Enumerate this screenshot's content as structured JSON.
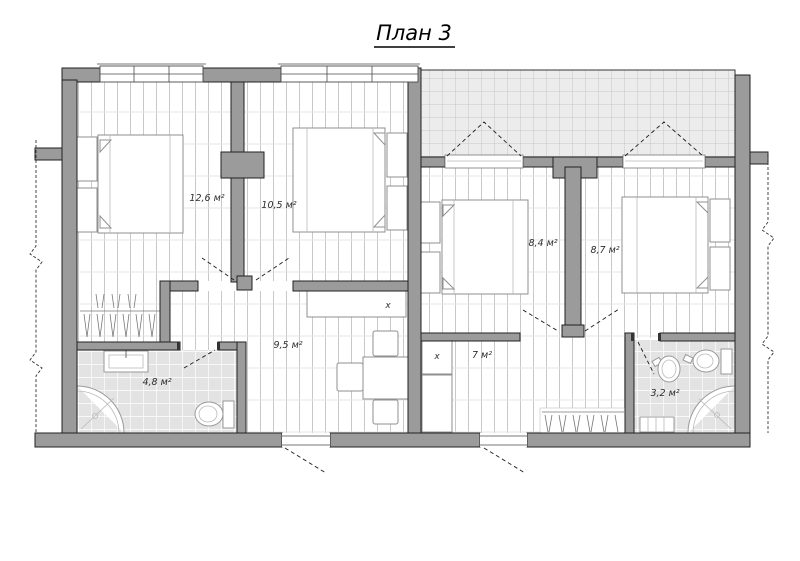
{
  "title": "План 3",
  "rooms": [
    {
      "name": "bedroom-1",
      "area_label": "12,6 м²"
    },
    {
      "name": "bedroom-2",
      "area_label": "10,5 м²"
    },
    {
      "name": "hallway-left",
      "area_label": "9,5 м²"
    },
    {
      "name": "bathroom-left",
      "area_label": "4,8 м²"
    },
    {
      "name": "bedroom-3",
      "area_label": "8,4 м²"
    },
    {
      "name": "bedroom-4",
      "area_label": "8,7 м²"
    },
    {
      "name": "hallway-right",
      "area_label": "7 м²"
    },
    {
      "name": "bathroom-right",
      "area_label": "3,2 м²"
    }
  ],
  "symbols": {
    "shaft_left": "x",
    "shaft_right": "x"
  },
  "colors": {
    "wall_fill": "#9b9b9b",
    "wall_outline": "#222222",
    "floor_line": "#c9c9c9",
    "tile_fill": "#e3e3e3",
    "terrace_fill": "#ececec",
    "terrace_line": "#bdbdbd",
    "fixture_outline": "#8f8f8f"
  }
}
